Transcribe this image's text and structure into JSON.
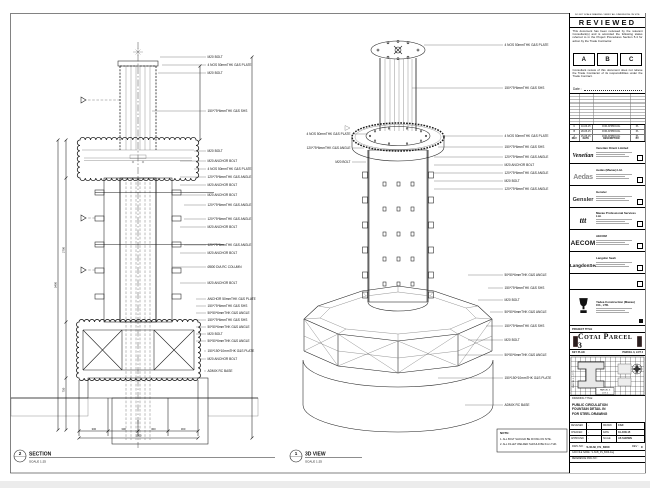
{
  "views": {
    "section": {
      "num": "2",
      "title": "SECTION",
      "scale": "SCALE 1:25"
    },
    "iso": {
      "num": "1",
      "title": "3D VIEW",
      "scale": "SCALE 1:25"
    }
  },
  "note": {
    "title": "NOTE:",
    "lines": [
      "1. ALL BOLT SHOULD BE FIXING ON SITE.",
      "2. ALL FILLET WELDED SHOULD BE 6mm THK."
    ]
  },
  "callouts": {
    "section": [
      "M20 BOLT",
      "4 NOS 50mmTHK G&S PLATE",
      "M20 BOLT",
      "150*75*6mmTHK G&S SHS",
      "M20 BOLT",
      "M20 ANCHOR BOLT",
      "4 NOS 50mmTHK G&S PLATE",
      "120*75*6mmTHK G&S ANGLE",
      "M20 ANCHOR BOLT",
      "M20 ANCHOR BOLT",
      "120*75*6mmTHK G&S ANGLE",
      "120*75*6mmTHK G&S ANGLE",
      "M20 ANCHOR BOLT",
      "120*75*6mmTHK G&S ANGLE",
      "M20 ANCHOR BOLT",
      "Ø800 DIA RC COLUMN",
      "M20 ANCHOR BOLT",
      "ANCHOR 50mmTHK G&S PLATE",
      "150*75*6mmTHK G&S SHS",
      "50*50*6mmTHK G&S ANGLE",
      "150*75*6mmTHK G&S SHS",
      "50*50*6mmTHK G&S ANGLE",
      "M20 BOLT",
      "50*50*6mmTHK G&S ANGLE",
      "150*150*10mmTHK G&S PLATE",
      "M20 ANCHOR BOLT",
      "ADMIX RC BASE"
    ],
    "iso_right": [
      "4 NOS 50mmTHK G&S PLATE",
      "150*75*6mmTHK G&S SHS",
      "4 NOS 50mmTHK G&S PLATE",
      "150*75*6mmTHK G&S SHS",
      "120*75*6mmTHK G&S ANGLE",
      "M20 ANCHOR BOLT",
      "120*75*6mmTHK G&S ANGLE",
      "M20 BOLT",
      "120*75*6mmTHK G&S ANGLE"
    ],
    "iso_base": [
      "50*50*6mmTHK G&S ANGLE",
      "150*75*6mmTHK G&S SHS",
      "M20 BOLT",
      "50*50*6mmTHK G&S ANGLE",
      "150*75*6mmTHK G&S SHS",
      "M20 BOLT",
      "50*50*6mmTHK G&S ANGLE",
      "150*150*10mmTHK G&S PLATE",
      "ADMIX RC BASE"
    ],
    "iso_left": [
      "4 NOS 50mmTHK G&S PLATE",
      "120*75*6mmTHK G&S ANGLE",
      "M20 BOLT"
    ]
  },
  "dims": {
    "bottom_segments": [
      "300",
      "300",
      "300",
      "300"
    ],
    "bottom_total": "1200",
    "left_mid": "2700",
    "left_low": "750",
    "left_total": "5400"
  },
  "stamp": {
    "topline": "DO NOT SCALE DRAWING. VERIFY ALL DIMENSIONS ON SITE.",
    "title": "REVIEWED",
    "para1": "This document has been reviewed by the relevant Consultant(s) and is accorded the following status referred to in the Project Procedures Section 5.4 for action by the Trade Contractor.",
    "options": [
      "A",
      "B",
      "C"
    ],
    "para2": "Consultant review of this document does not relieve the Trade Contractor of its responsibilities under the Trade Contract.",
    "date_label": "Date :"
  },
  "revisions": {
    "header": [
      "REV",
      "DATE",
      "DESCRIPTION",
      "BY"
    ],
    "rows": [
      [
        "C",
        "10-06-15",
        "FOR APPROVAL",
        "PL"
      ],
      [
        "B",
        "28-05-15",
        "FOR APPROVAL",
        "PL"
      ],
      [
        "A",
        "15-05-15",
        "FOR APPROVAL",
        "PL"
      ]
    ]
  },
  "consultants": [
    {
      "logo": "Venetian",
      "name": "Venetian Orient Limited"
    },
    {
      "logo": "Aedas",
      "name": "Aedas (Macau) Ltd."
    },
    {
      "logo": "Gensler",
      "name": "Gensler"
    },
    {
      "logo": "ttt",
      "name": "Macau Professional Services Ltd."
    },
    {
      "logo": "AECOM",
      "name": "AECOM"
    },
    {
      "logo": "LangdonSeah",
      "name": "Langdon Seah"
    }
  ],
  "contractor": {
    "name": "Yadea Construction (Macau) CO., LTD."
  },
  "project": {
    "label": "PROJECT TITLE",
    "name": "Cotai Parcel 3"
  },
  "keyplan": {
    "label": "KEY PLAN",
    "lot": "PARCEL 3, LOT 2",
    "side": "PARCEL 1, LOT 1",
    "tag_line1": "PARCEL 3",
    "tag_line2": "LOT 2"
  },
  "titleblock": {
    "label": "DRAWING TITLE:",
    "title_lines": [
      "PUBLIC CIRCULATION",
      "FOUNTAIN DETAIL IN",
      "FOR STEEL DRAWING"
    ],
    "fields": [
      {
        "k": "DESIGNED",
        "v": "-"
      },
      {
        "k": "DRAWN",
        "v": "CAD"
      },
      {
        "k": "CHECKED",
        "v": "-"
      },
      {
        "k": "DATE",
        "v": "19-JUN-15"
      },
      {
        "k": "APPROVED",
        "v": "-"
      },
      {
        "k": "SCALE",
        "v": "AS SHOWN"
      }
    ],
    "dwg_label": "DWG NO :",
    "dwg_no": "S-SUB_FS_8000",
    "rev_label": "REV :",
    "rev": "C",
    "cad_label": "CAD FILE NAME :",
    "cad_value": "S-SUB_FS_8000.dwg",
    "ref_label": "REFERENCE DWG NO :"
  }
}
